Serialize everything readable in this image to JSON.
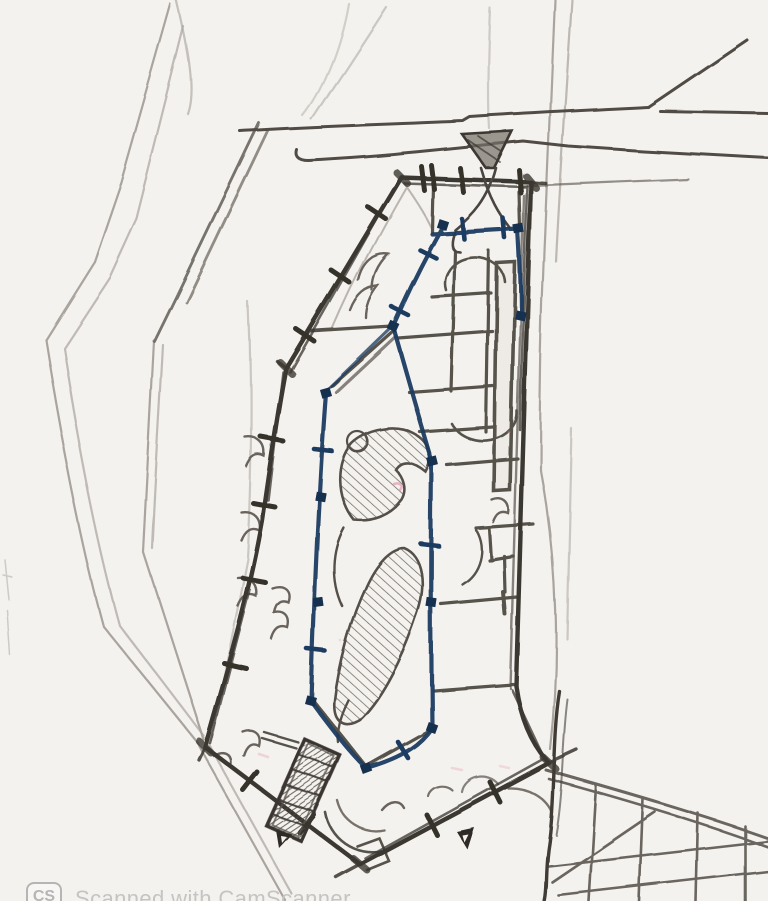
{
  "watermark": {
    "badge_label": "CS",
    "text": "Scanned with CamScanner"
  },
  "palette": {
    "paper": "#f5f3ef",
    "pencil_light": "#97908a",
    "pencil_mid": "#6b655e",
    "pencil_dark": "#3b3731",
    "ink_blue": "#1c3a60",
    "node_blue": "#16304f",
    "pink_mark": "#e08bab",
    "watermark_gray": "#bdbdbd"
  },
  "sketch": {
    "kind": "hand-drawn architectural site plan, pencil and blue ballpoint ink, scanned",
    "elements": [
      "site-boundary",
      "access-road",
      "entrance-funnel",
      "building-outer-wall",
      "door-opening-ticks",
      "interior-partitions",
      "window-scallops",
      "courtyard-blue-wall",
      "corner-nodes",
      "hatched-rock-forms",
      "staircase-block",
      "direction-arrows",
      "paved-grid-area"
    ]
  }
}
